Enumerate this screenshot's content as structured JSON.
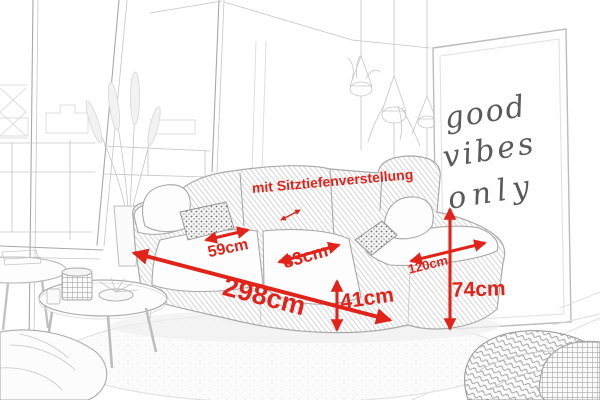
{
  "annotation": {
    "seat_depth_note": "mit Sitztiefenverstellung"
  },
  "dimensions": {
    "overall_width": "298cm",
    "seat_left_width": "59cm",
    "seat_right_width": "83cm",
    "seat_height": "41cm",
    "seat_depth": "120cm",
    "total_height": "74cm"
  },
  "poster": {
    "line1": "good",
    "line2": "vibes",
    "line3": "only"
  },
  "colors": {
    "dimension_red": "#e2231a",
    "sketch_gray": "#a8a8a8",
    "background": "#ffffff"
  }
}
